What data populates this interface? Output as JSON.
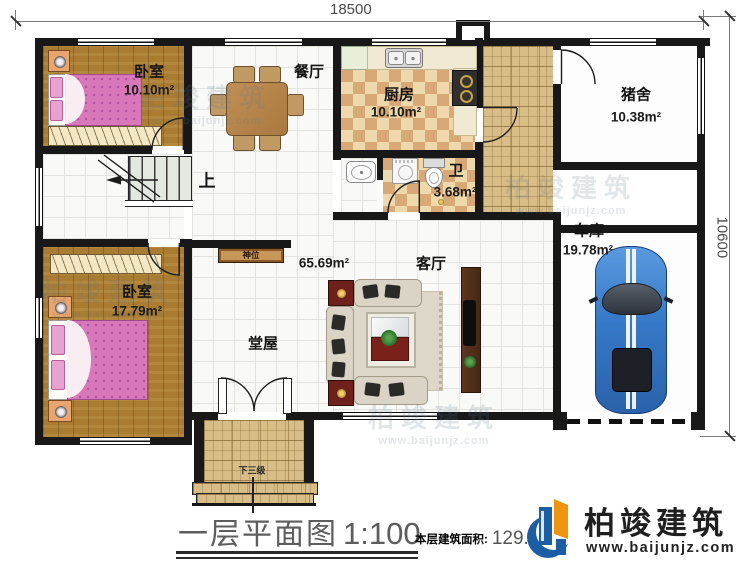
{
  "dimensions": {
    "top": "18500",
    "right": "10600"
  },
  "rooms": {
    "bedroom1": {
      "name": "卧室",
      "area": "10.10m²"
    },
    "dining": {
      "name": "餐厅"
    },
    "kitchen": {
      "name": "厨房",
      "area": "10.10m²"
    },
    "bathroom": {
      "name": "卫",
      "area": "3.68m²"
    },
    "pigpen": {
      "name": "猪舍",
      "area": "10.38m²"
    },
    "garage": {
      "name": "车库",
      "area": "19.78m²"
    },
    "living": {
      "name": "客厅"
    },
    "hall": {
      "name": "堂屋",
      "area": "65.69m²"
    },
    "bedroom2": {
      "name": "卧室",
      "area": "17.79m²"
    }
  },
  "annotations": {
    "stairs_up": "上",
    "shrine": "神位",
    "entry_steps": "下三级"
  },
  "titleblock": {
    "plan_title": "一层平面图",
    "scale": "1:100",
    "area_label": "本层建筑面积:",
    "area_value": "129.93"
  },
  "brand": {
    "name": "柏竣建筑",
    "website": "www.baijunjz.com"
  },
  "watermark": {
    "text": "柏竣建筑",
    "sub": "www.baijunjz.com"
  },
  "colors": {
    "wall": "#181818",
    "wood": "#a97c31",
    "bed_pink": "#d977bb",
    "checker_light": "#eed9aa",
    "checker_dark": "#d9a877",
    "stone": "#d9bd87",
    "car_blue": "#3579c8",
    "brand_blue": "#1b5ea6",
    "brand_orange": "#f0930f"
  }
}
